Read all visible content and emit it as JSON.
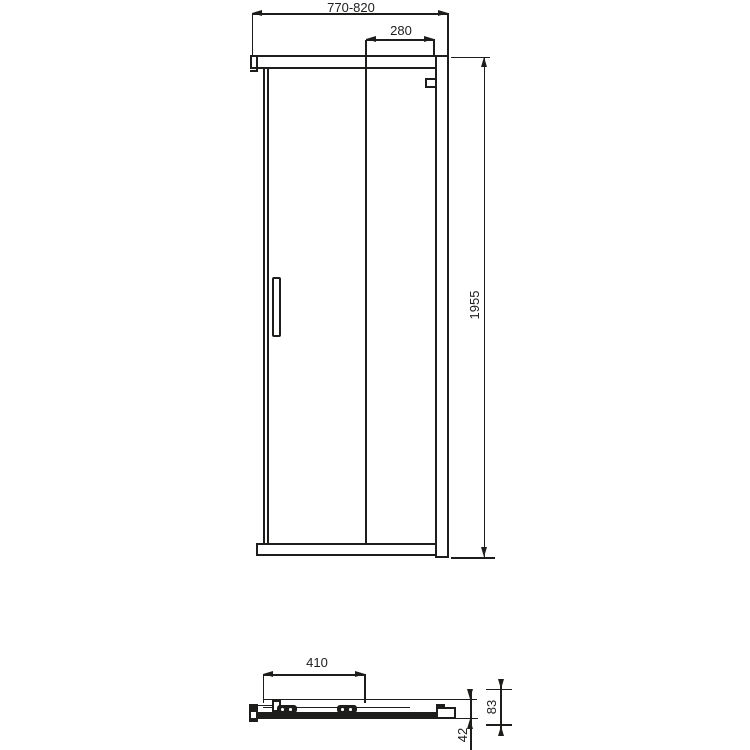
{
  "drawing": {
    "type": "technical-dimension-drawing",
    "subject": "sliding shower door enclosure",
    "line_color": "#1d1d1b",
    "background_color": "#ffffff",
    "front_view": {
      "overall_width": "770-820",
      "door_panel_width": "280",
      "height": "1955"
    },
    "plan_view": {
      "panel_length": "410",
      "profile_depth": "83",
      "profile_offset": "42"
    }
  }
}
